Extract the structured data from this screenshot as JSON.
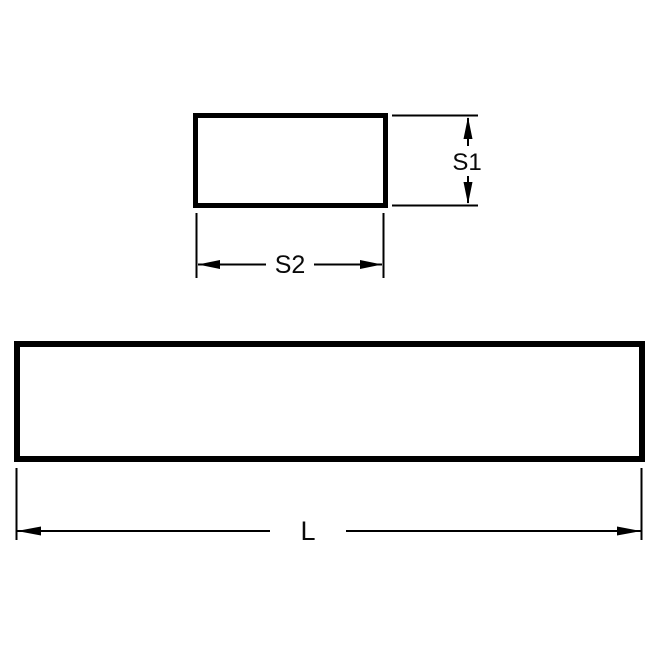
{
  "drawing": {
    "labels": {
      "s1": "S1",
      "s2": "S2",
      "l": "L"
    },
    "colors": {
      "line": "#000000",
      "text": "#0a0a0a",
      "background": "#ffffff"
    }
  }
}
